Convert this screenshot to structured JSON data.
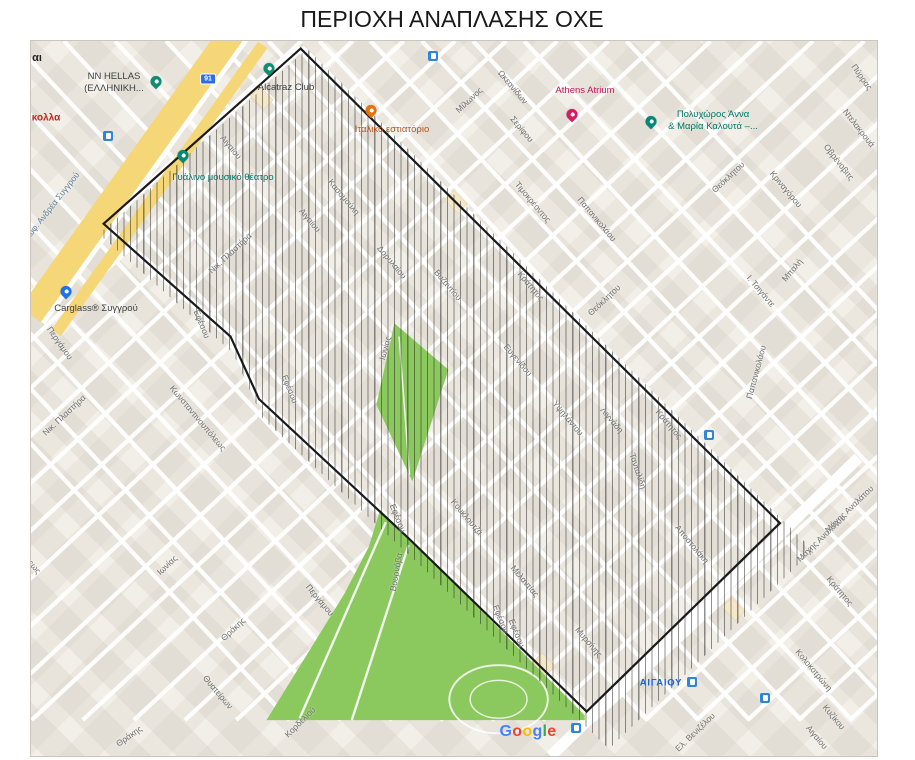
{
  "title": "ΠΕΡΙΟΧΗ ΑΝΑΠΛΑΣΗΣ ΟΧΕ",
  "map": {
    "attribution": "Google",
    "area_label": {
      "text": "ΑΙΓΑΙΟΥ",
      "x": 660,
      "y": 682,
      "color": "#1967d2"
    },
    "route_badge": {
      "text": "91",
      "x": 207,
      "y": 78
    },
    "colors": {
      "map_bg": "#f2efe8",
      "road": "#ffffff",
      "park": "#8bc95e",
      "syngrou_yellow": "#f5d778",
      "outline": "#1a1a1a",
      "street_label": "#6f6f6f",
      "transit_blue": "#2f86d6",
      "badge_blue": "#2d6ce5"
    },
    "hatch_polygon": [
      [
        306,
        48
      ],
      [
        812,
        549
      ],
      [
        608,
        748
      ],
      [
        420,
        565
      ],
      [
        262,
        418
      ],
      [
        232,
        352
      ],
      [
        98,
        233
      ]
    ],
    "parks": [
      [
        [
          405,
          338
        ],
        [
          462,
          387
        ],
        [
          424,
          505
        ],
        [
          386,
          424
        ]
      ],
      [
        [
          390,
          535
        ],
        [
          422,
          566
        ],
        [
          606,
          752
        ],
        [
          606,
          757
        ],
        [
          270,
          757
        ],
        [
          352,
          624
        ],
        [
          378,
          574
        ]
      ]
    ],
    "syngrou_axis": {
      "main": [
        [
          240,
          25
        ],
        [
          22,
          330
        ]
      ],
      "service": [
        [
          266,
          44
        ],
        [
          48,
          348
        ]
      ]
    },
    "pois": [
      {
        "lines": [
          "NN HELLAS",
          "(ΕΛΛΗΝΙΚΗ..."
        ],
        "x": 113,
        "y": 82,
        "color": "#3c4043",
        "pin": {
          "x": 155,
          "y": 86,
          "color": "#0e8f72"
        }
      },
      {
        "lines": [
          "Alcatraz Club"
        ],
        "x": 285,
        "y": 87,
        "color": "#3c4043",
        "pin": {
          "x": 268,
          "y": 73,
          "color": "#0e8f72"
        }
      },
      {
        "lines": [
          "Γυάλινο μουσικό θέατρο"
        ],
        "x": 222,
        "y": 177,
        "color": "#00796b",
        "pin": {
          "x": 182,
          "y": 160,
          "color": "#00897b"
        }
      },
      {
        "lines": [
          "Ιταλικό εστιατόριο"
        ],
        "x": 391,
        "y": 129,
        "color": "#b3541e",
        "pin": {
          "x": 370,
          "y": 115,
          "color": "#e8710a"
        }
      },
      {
        "lines": [
          "Athens Atrium"
        ],
        "x": 584,
        "y": 90,
        "color": "#c2185b",
        "pin": {
          "x": 571,
          "y": 119,
          "color": "#d81b60"
        }
      },
      {
        "lines": [
          "Πολυχώρος Άννα",
          "& Μαρία Καλουτά –..."
        ],
        "x": 712,
        "y": 120,
        "color": "#00796b",
        "pin": {
          "x": 650,
          "y": 126,
          "color": "#00897b"
        }
      },
      {
        "lines": [
          "Carglass® Συγγρού"
        ],
        "x": 95,
        "y": 308,
        "color": "#3c4043",
        "pin": {
          "x": 65,
          "y": 296,
          "color": "#1a73e8"
        }
      }
    ],
    "street_labels": [
      {
        "text": "Λεωφ. Ανδρέα Συγγρού",
        "x": 49,
        "y": 207,
        "rot": -52,
        "c": "#5e7f99"
      },
      {
        "text": "Αιγαίου",
        "x": 230,
        "y": 146,
        "rot": 50
      },
      {
        "text": "Αιγαίου",
        "x": 309,
        "y": 219,
        "rot": 50
      },
      {
        "text": "Νικ. Πλαστήρα",
        "x": 229,
        "y": 252,
        "rot": -43
      },
      {
        "text": "Νικ. Πλαστήρα",
        "x": 63,
        "y": 414,
        "rot": -43
      },
      {
        "text": "Κασομούλη",
        "x": 343,
        "y": 196,
        "rot": 50
      },
      {
        "text": "Δορυλαίου",
        "x": 391,
        "y": 261,
        "rot": 50
      },
      {
        "text": "Βυζαντίου",
        "x": 447,
        "y": 284,
        "rot": 50
      },
      {
        "text": "Μίλωνος",
        "x": 468,
        "y": 99,
        "rot": -43
      },
      {
        "text": "Ωκεανίδων",
        "x": 512,
        "y": 86,
        "rot": 50
      },
      {
        "text": "Σερίφου",
        "x": 521,
        "y": 128,
        "rot": 50
      },
      {
        "text": "Τιμοκρέοντος",
        "x": 532,
        "y": 201,
        "rot": 50
      },
      {
        "text": "Παπανικολάου",
        "x": 596,
        "y": 218,
        "rot": 50
      },
      {
        "text": "Θεόκλητου",
        "x": 727,
        "y": 176,
        "rot": -43
      },
      {
        "text": "Θεόκλητου",
        "x": 603,
        "y": 299,
        "rot": -43
      },
      {
        "text": "Κριναγόρου",
        "x": 785,
        "y": 188,
        "rot": 50
      },
      {
        "text": "Πύρρας",
        "x": 861,
        "y": 76,
        "rot": 55
      },
      {
        "text": "Ντελακρουά",
        "x": 858,
        "y": 127,
        "rot": 52
      },
      {
        "text": "Οβρένοβιτς",
        "x": 838,
        "y": 161,
        "rot": 52
      },
      {
        "text": "Μπαλή",
        "x": 791,
        "y": 269,
        "rot": -50
      },
      {
        "text": "Ι. Τσιγάντε",
        "x": 760,
        "y": 290,
        "rot": 50
      },
      {
        "text": "Κράτητος",
        "x": 530,
        "y": 285,
        "rot": 50
      },
      {
        "text": "Κράτητος",
        "x": 668,
        "y": 423,
        "rot": 50
      },
      {
        "text": "Κράτητος",
        "x": 839,
        "y": 590,
        "rot": 50
      },
      {
        "text": "Ευγενίδου",
        "x": 517,
        "y": 359,
        "rot": 50
      },
      {
        "text": "Υψηλάντου",
        "x": 567,
        "y": 417,
        "rot": 50
      },
      {
        "text": "Λιγνάδη",
        "x": 611,
        "y": 419,
        "rot": 50
      },
      {
        "text": "Τανταλίδη",
        "x": 637,
        "y": 470,
        "rot": 72
      },
      {
        "text": "Αποστολάκη",
        "x": 691,
        "y": 543,
        "rot": 50
      },
      {
        "text": "Παπανικολάου",
        "x": 755,
        "y": 371,
        "rot": -75
      },
      {
        "text": "Εφέσου",
        "x": 201,
        "y": 323,
        "rot": 68
      },
      {
        "text": "Εφέσου",
        "x": 289,
        "y": 388,
        "rot": 68
      },
      {
        "text": "Εφέσου",
        "x": 397,
        "y": 517,
        "rot": 68
      },
      {
        "text": "Εφέσου",
        "x": 500,
        "y": 618,
        "rot": 68
      },
      {
        "text": "Εφέσου",
        "x": 516,
        "y": 632,
        "rot": 68
      },
      {
        "text": "Κωνσταντινουπόλεως",
        "x": 197,
        "y": 417,
        "rot": 50
      },
      {
        "text": "Κωνσταντινουπόλεως",
        "x": 12,
        "y": 540,
        "rot": 50
      },
      {
        "text": "Περγάμου",
        "x": 59,
        "y": 342,
        "rot": 55
      },
      {
        "text": "Περγάμου",
        "x": 319,
        "y": 599,
        "rot": 50
      },
      {
        "text": "Ιωνίας",
        "x": 166,
        "y": 564,
        "rot": -43
      },
      {
        "text": "Ιωνίας",
        "x": 384,
        "y": 347,
        "rot": -75
      },
      {
        "text": "Θράκης",
        "x": 232,
        "y": 628,
        "rot": -43
      },
      {
        "text": "Θράκης",
        "x": 128,
        "y": 735,
        "rot": -35
      },
      {
        "text": "Θυατείρων",
        "x": 217,
        "y": 691,
        "rot": 50
      },
      {
        "text": "Κορδελιού",
        "x": 299,
        "y": 721,
        "rot": -45
      },
      {
        "text": "Βουρνόβα",
        "x": 395,
        "y": 571,
        "rot": -80
      },
      {
        "text": "Κουκλουτζά",
        "x": 466,
        "y": 516,
        "rot": 50
      },
      {
        "text": "Μελαντίας",
        "x": 524,
        "y": 580,
        "rot": 50
      },
      {
        "text": "Μυρσίνης",
        "x": 588,
        "y": 641,
        "rot": 50
      },
      {
        "text": "Μάχης Αναλάτου",
        "x": 820,
        "y": 537,
        "rot": -44
      },
      {
        "text": "Μάχης Αναλάτου",
        "x": 848,
        "y": 508,
        "rot": -44
      },
      {
        "text": "Κολοκοτρώνη",
        "x": 813,
        "y": 669,
        "rot": 50
      },
      {
        "text": "Κυζίκου",
        "x": 833,
        "y": 716,
        "rot": 50
      },
      {
        "text": "Αιγαίου",
        "x": 816,
        "y": 736,
        "rot": 50
      },
      {
        "text": "Ελ. Βενιζέλου",
        "x": 694,
        "y": 731,
        "rot": -44
      }
    ],
    "partial_texts": [
      {
        "text": "αι",
        "x": 36,
        "y": 57,
        "color": "#222222",
        "fs": 11
      },
      {
        "text": "κολλα",
        "x": 45,
        "y": 117,
        "color": "#c5221f",
        "fs": 10
      }
    ],
    "transit_icons": [
      [
        107,
        135
      ],
      [
        432,
        55
      ],
      [
        708,
        434
      ],
      [
        691,
        681
      ],
      [
        764,
        697
      ],
      [
        575,
        727
      ]
    ],
    "google_logo": {
      "text": "Google",
      "x": 527,
      "y": 731
    }
  }
}
